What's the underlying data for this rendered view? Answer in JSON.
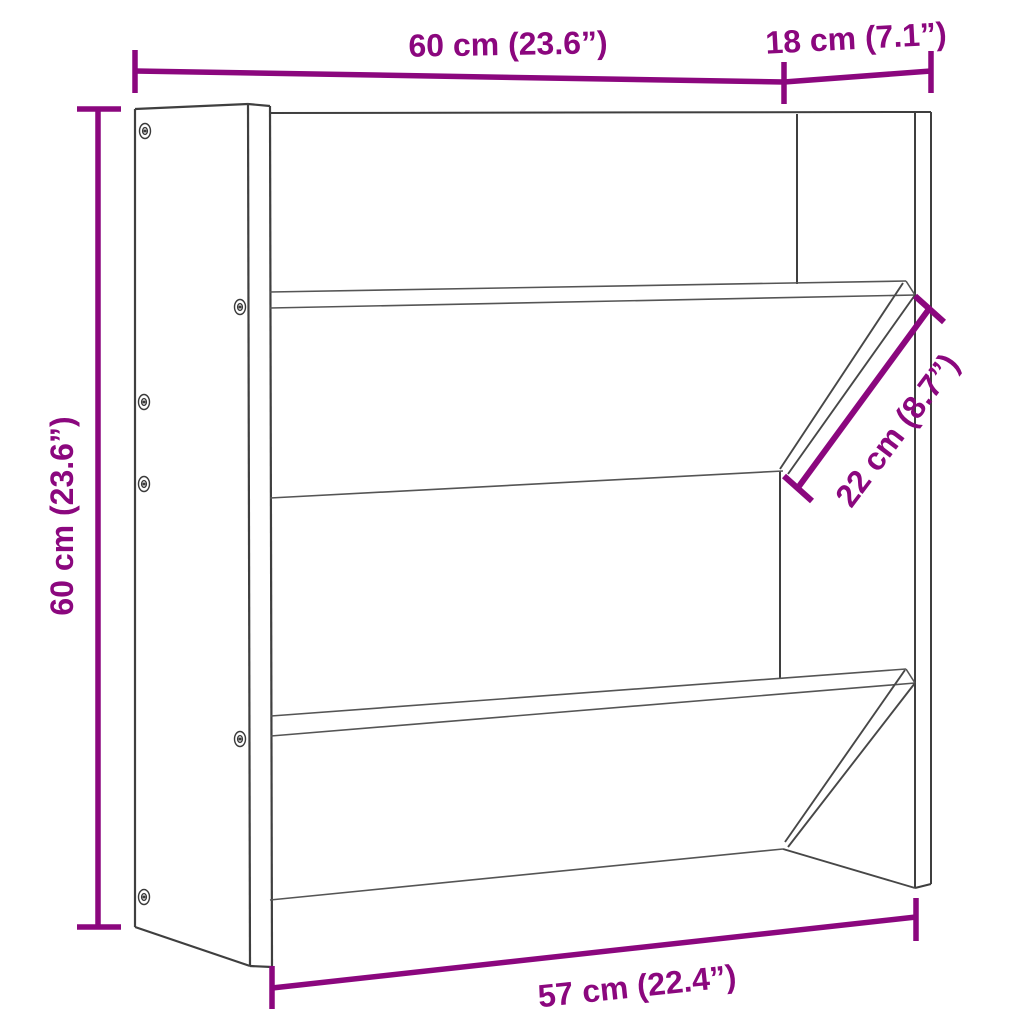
{
  "diagram": {
    "object": "wall-mounted-shoe-rack-two-angled-shelves",
    "background_color": "#ffffff",
    "outline_color": "#3f3f3f",
    "dimension_color": "#8B077E",
    "annotations": {
      "width_top": "60 cm (23.6”)",
      "depth_top": "18 cm (7.1”)",
      "height_left": "60 cm (23.6”)",
      "shelf_diagonal": "22 cm (8.7”)",
      "width_bottom": "57 cm (22.4”)"
    },
    "values": {
      "width_top_cm": 60,
      "width_top_in": 23.6,
      "depth_top_cm": 18,
      "depth_top_in": 7.1,
      "height_cm": 60,
      "height_in": 23.6,
      "shelf_depth_cm": 22,
      "shelf_depth_in": 8.7,
      "width_bottom_cm": 57,
      "width_bottom_in": 22.4
    },
    "screw_count": 6
  }
}
